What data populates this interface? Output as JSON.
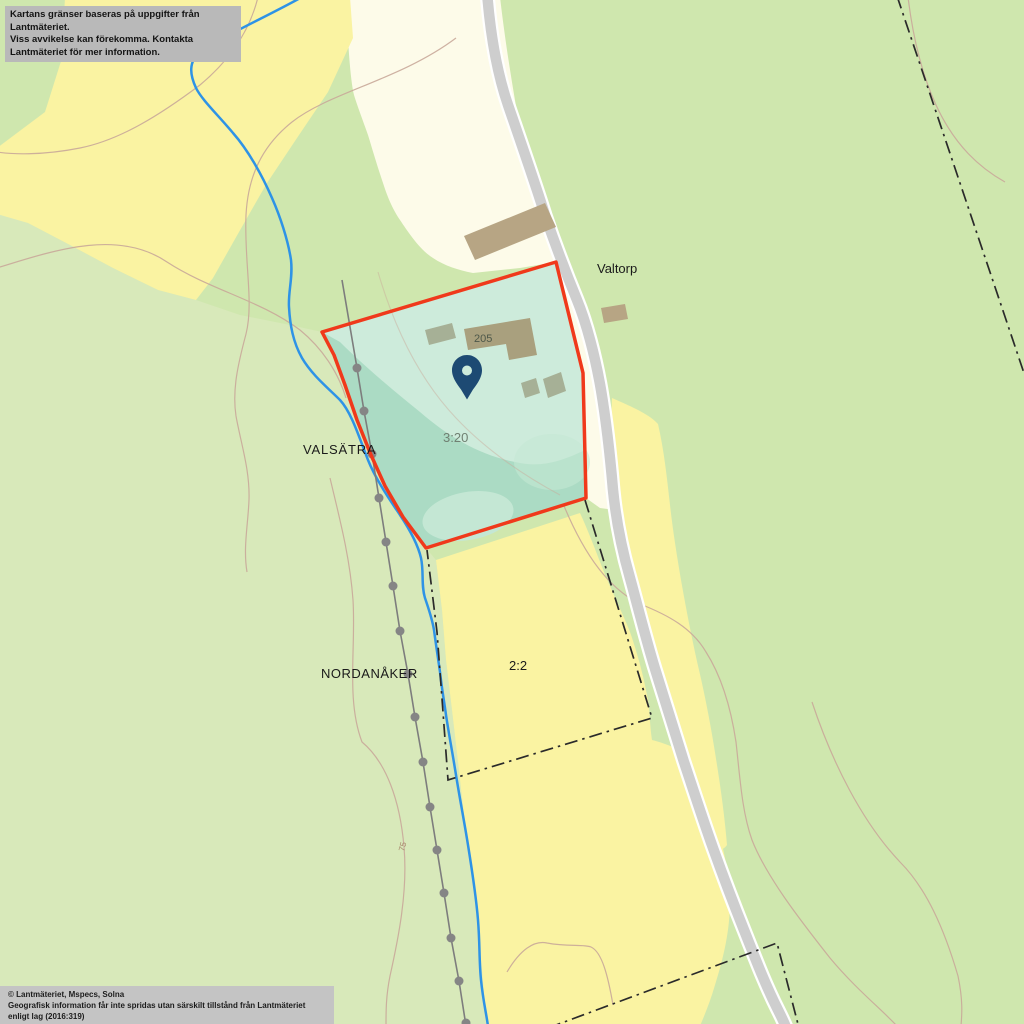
{
  "attribution": {
    "disclaimer_line1": "Kartans gränser baseras på uppgifter från Lantmäteriet.",
    "disclaimer_line2": "Viss avvikelse kan förekomma. Kontakta Lantmäteriet för mer information.",
    "copyright_line1": "© Lantmäteriet, Mspecs, Solna",
    "copyright_line2": "Geografisk information får inte spridas utan särskilt tillstånd från Lantmäteriet enligt lag (2016:319)"
  },
  "labels": {
    "place_valtorp": "Valtorp",
    "place_valsatra": "VALSÄTRA",
    "place_nordanaker": "NORDANÅKER",
    "parcel_highlighted": "3:20",
    "parcel_south": "2:2",
    "building_number": "205",
    "contour_elevation": "75"
  },
  "marker": {
    "type": "location-pin",
    "color": "#1d4a73"
  },
  "colors": {
    "forest_green": "#cfe7ae",
    "west_green": "#d8e9ba",
    "field_yellow": "#faf3a2",
    "open_cream": "#fdfbe9",
    "road_gray": "#cecece",
    "road_casing": "#ffffff",
    "stream_blue": "#2e93e6",
    "contour_brown": "#c9a99a",
    "boundary_red": "#f0391b",
    "parcel_fill": "#abdbc4",
    "parcel_fill_light": "#cdebdb",
    "parcel_fill_blob": "#c4e7d4",
    "building_tan": "#b7a584",
    "building_olive": "#a9a07e",
    "building_gray": "#a6b096",
    "cadastral_line": "#2a2a2a",
    "survey_line": "#7d7d7d",
    "survey_dot": "#858585",
    "parcel_label_gray": "#708072",
    "building_label": "#4e584a"
  }
}
